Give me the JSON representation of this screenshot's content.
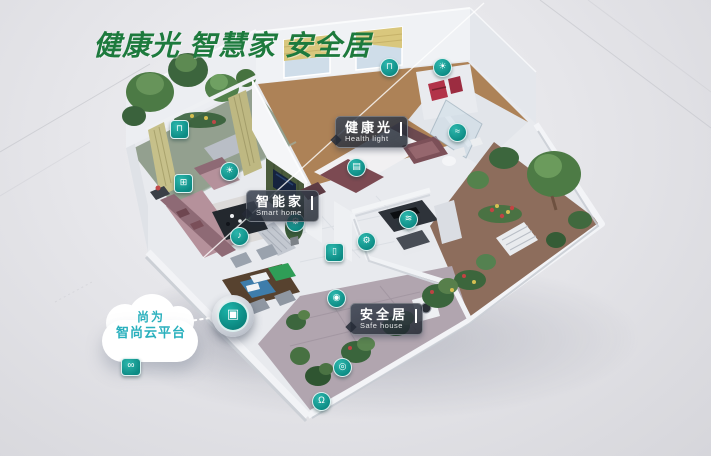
{
  "title": "健康光 智慧家 安全居",
  "tags": {
    "health_light": {
      "zh": "健康光",
      "en": "Health light"
    },
    "smart_home": {
      "zh": "智能家",
      "en": "Smart home"
    },
    "safe_house": {
      "zh": "安全居",
      "en": "Safe house"
    }
  },
  "cloud": {
    "line1": "尚为",
    "line2": "智尚云平台"
  },
  "hub": {
    "glyph": "▣"
  },
  "link_icon": {
    "glyph": "∞"
  },
  "icons": [
    {
      "name": "curtain-icon",
      "glyph": "⊓"
    },
    {
      "name": "window-icon",
      "glyph": "⊞"
    },
    {
      "name": "ceiling-light-icon",
      "glyph": "☀"
    },
    {
      "name": "voice-speaker-icon",
      "glyph": "♪"
    },
    {
      "name": "gear-icon",
      "glyph": "⚙"
    },
    {
      "name": "curtain-icon",
      "glyph": "⊓"
    },
    {
      "name": "ceiling-light-icon",
      "glyph": "☀"
    },
    {
      "name": "switch-panel-icon",
      "glyph": "▤"
    },
    {
      "name": "wifi-icon",
      "glyph": "≋"
    },
    {
      "name": "gear-icon",
      "glyph": "⚙"
    },
    {
      "name": "door-icon",
      "glyph": "▯"
    },
    {
      "name": "sensor-icon",
      "glyph": "◉"
    },
    {
      "name": "water-icon",
      "glyph": "≈"
    },
    {
      "name": "camera-icon",
      "glyph": "◎"
    },
    {
      "name": "lock-icon",
      "glyph": "Ω"
    }
  ],
  "colors": {
    "title_green": "#1d7a3d",
    "icon_teal": "#0f9a92",
    "cloud_text": "#29b0bd",
    "tag_bg": "rgba(35,42,54,0.85)",
    "artwork_red": "#b23349"
  }
}
